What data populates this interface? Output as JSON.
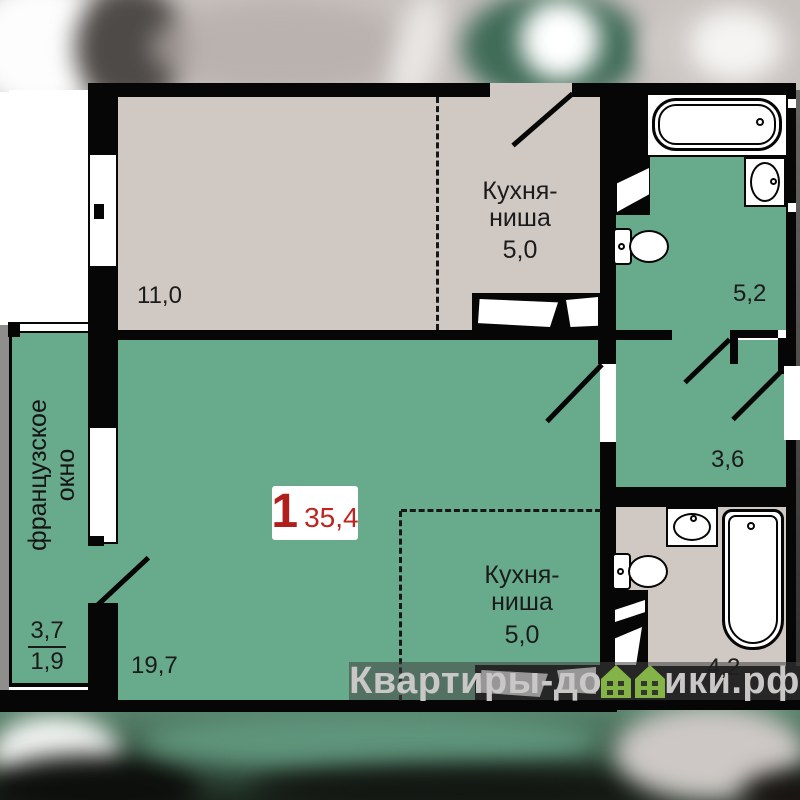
{
  "unit_card": {
    "rooms_count": "1",
    "total_area": "35,4"
  },
  "upper_unit": {
    "living_area": "11,0",
    "kitchen_line1": "Кухня-",
    "kitchen_line2": "ниша",
    "kitchen_area": "5,0",
    "bathroom_area": "5,2"
  },
  "lower_unit": {
    "living_area": "19,7",
    "kitchen_line1": "Кухня-",
    "kitchen_line2": "ниша",
    "kitchen_area": "5,0",
    "hall_area": "3,6",
    "bathroom_area": "4,2",
    "balcony_area_full": "3,7",
    "balcony_area_reduced": "1,9",
    "french_window_line1": "французское",
    "french_window_line2": "окно"
  },
  "watermark": {
    "prefix": "Квартиры-до",
    "suffix": "ики.рф",
    "icon": "double-house-icon"
  },
  "colors": {
    "floor_green": "#68AA8C",
    "floor_beige": "#CFC8C3",
    "wall_black": "#060606",
    "accent_red": "#B1221E",
    "watermark_text": "#C9C8C6",
    "watermark_house_green": "#84B347"
  }
}
